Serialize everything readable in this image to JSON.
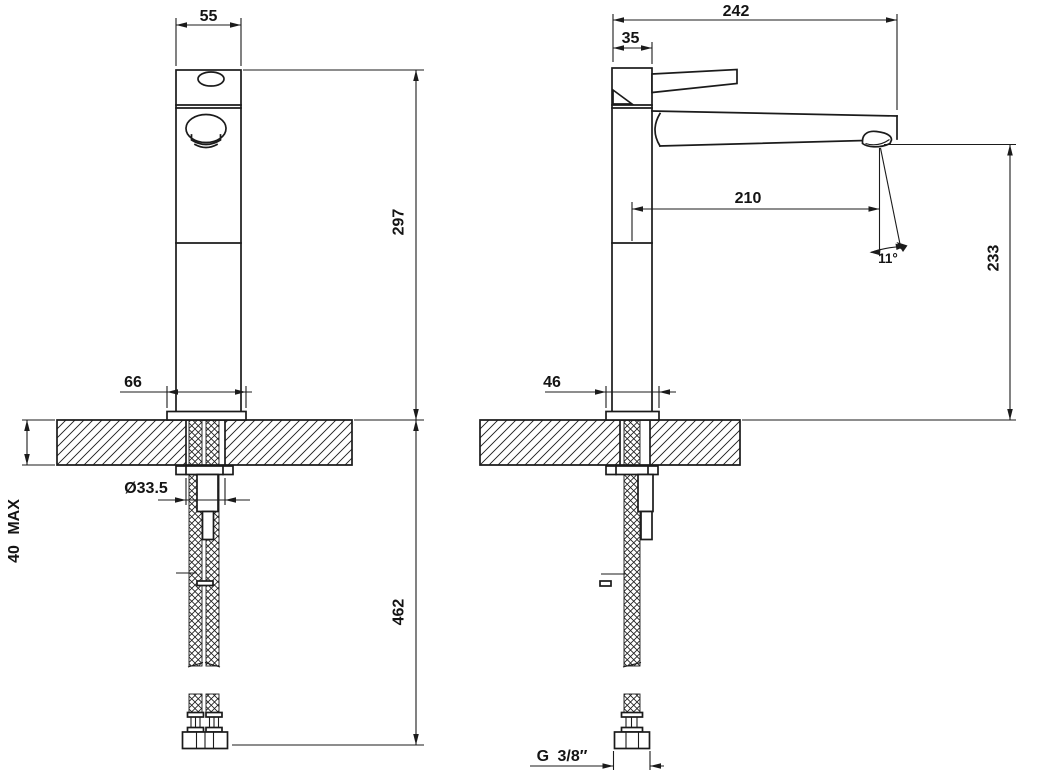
{
  "drawing": {
    "background": "#ffffff",
    "line_color": "#1b1b1b",
    "front_view": {
      "name": "front view",
      "dims": {
        "body_width": "55",
        "height_above_deck": "297",
        "base_width": "66",
        "max_deck_thickness": "40 MAX",
        "hole_diameter": "Ø33.5",
        "hose_length": "462"
      }
    },
    "side_view": {
      "name": "side view",
      "dims": {
        "overall_depth": "242",
        "body_depth": "35",
        "spout_reach": "210",
        "stream_angle": "11°",
        "height_above_deck": "233",
        "base_depth": "46",
        "connection_thread": "G 3/8″"
      }
    }
  }
}
